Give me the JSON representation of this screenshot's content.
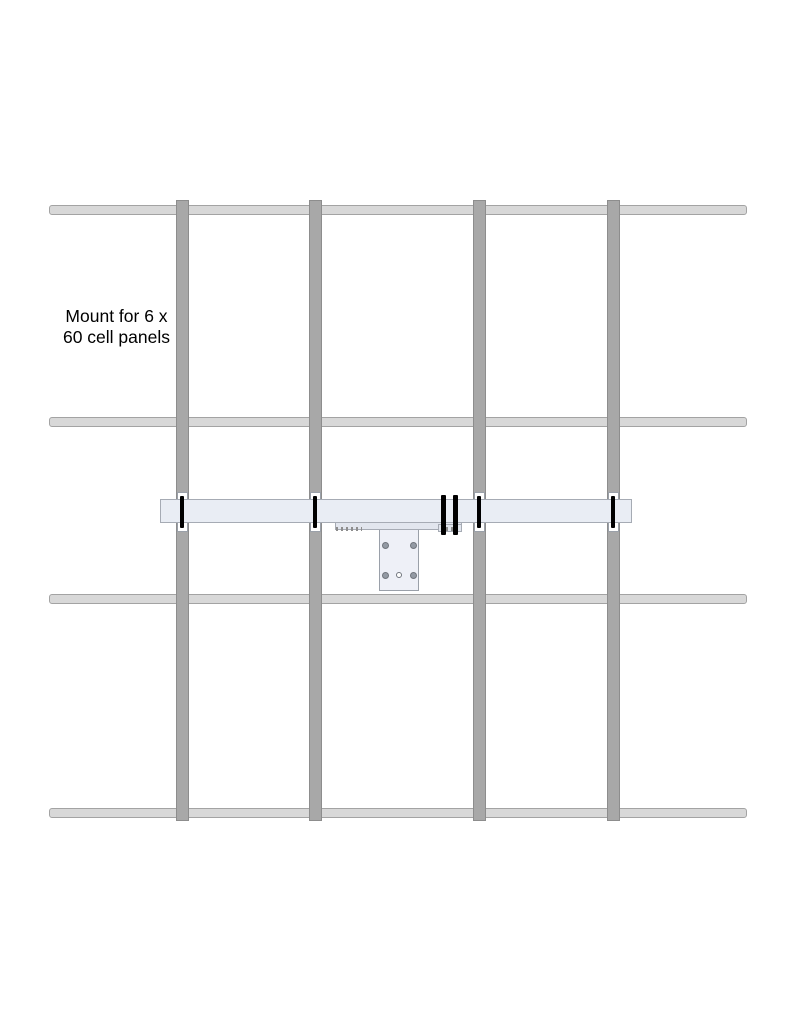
{
  "diagram": {
    "label": {
      "line1": "Mount for 6 x",
      "line2": "60 cell panels"
    },
    "components": {
      "vertical_rails": 4,
      "horizontal_rails": 4,
      "mount_beam": "horizontal mounting beam",
      "rail_clamps": 4,
      "middle_clamps": 2,
      "bracket_plate_holes": 5
    },
    "colors": {
      "background": "#ffffff",
      "v-rail-fill": "#a8a8a8",
      "v-rail-border": "#8d8d8d",
      "h-rail-fill": "#d8d8d8",
      "h-rail-border": "#a3a3a3",
      "beam-fill": "#e9edf4",
      "beam-border": "#a6abb4",
      "bar-fill": "#e2e6ee",
      "plate-fill": "#eef0f7",
      "plate-border": "#9aa0a9",
      "hole-fill": "#939aa4",
      "hole-ring": "#70757d",
      "clamp-color": "#000000"
    }
  }
}
